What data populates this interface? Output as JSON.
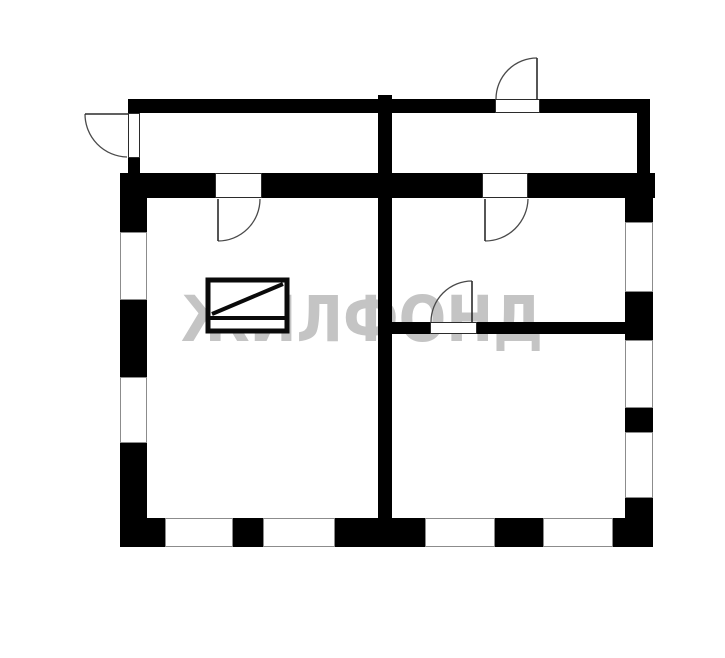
{
  "title": "apartment-floor-plan",
  "canvas": {
    "width": 725,
    "height": 658,
    "background": "#ffffff"
  },
  "watermark": {
    "text": "ЖИЛФОНД",
    "color": "#c4c4c4"
  },
  "style": {
    "wall_color": "#000000",
    "window_fill": "#ffffff",
    "window_stroke": "#8c8c8c",
    "opening_fill": "#ffffff",
    "opening_stroke": "#2b2b2b",
    "door_arc_color": "#4a4a4a",
    "symbol_color": "#0a0a0a"
  },
  "plan": {
    "walls": [
      {
        "name": "corridor-top-wall-left",
        "x": 128,
        "y": 99,
        "w": 367,
        "h": 14
      },
      {
        "name": "corridor-top-wall-right",
        "x": 540,
        "y": 99,
        "w": 110,
        "h": 14
      },
      {
        "name": "corridor-left-wall-stub",
        "x": 128,
        "y": 158,
        "w": 12,
        "h": 16
      },
      {
        "name": "corridor-right-wall",
        "x": 637,
        "y": 113,
        "w": 13,
        "h": 61
      },
      {
        "name": "center-wall",
        "x": 378,
        "y": 95,
        "w": 14,
        "h": 428
      },
      {
        "name": "top-wall-left",
        "x": 120,
        "y": 173,
        "w": 95,
        "h": 25
      },
      {
        "name": "top-wall-middle",
        "x": 262,
        "y": 173,
        "w": 220,
        "h": 25
      },
      {
        "name": "top-wall-right",
        "x": 528,
        "y": 173,
        "w": 127,
        "h": 25
      },
      {
        "name": "left-wall-upper",
        "x": 120,
        "y": 198,
        "w": 27,
        "h": 34
      },
      {
        "name": "left-wall-middle",
        "x": 120,
        "y": 300,
        "w": 27,
        "h": 77
      },
      {
        "name": "left-wall-lower",
        "x": 120,
        "y": 443,
        "w": 27,
        "h": 104
      },
      {
        "name": "bottom-wall-seg-1",
        "x": 120,
        "y": 518,
        "w": 45,
        "h": 29
      },
      {
        "name": "bottom-wall-seg-2",
        "x": 233,
        "y": 518,
        "w": 30,
        "h": 29
      },
      {
        "name": "bottom-wall-seg-3",
        "x": 335,
        "y": 518,
        "w": 90,
        "h": 29
      },
      {
        "name": "bottom-wall-seg-4",
        "x": 495,
        "y": 518,
        "w": 48,
        "h": 29
      },
      {
        "name": "bottom-wall-seg-5",
        "x": 613,
        "y": 518,
        "w": 40,
        "h": 29
      },
      {
        "name": "right-wall-upper",
        "x": 625,
        "y": 198,
        "w": 28,
        "h": 24
      },
      {
        "name": "right-wall-mid-1",
        "x": 625,
        "y": 292,
        "w": 28,
        "h": 48
      },
      {
        "name": "right-wall-mid-2",
        "x": 625,
        "y": 408,
        "w": 28,
        "h": 24
      },
      {
        "name": "right-wall-lower",
        "x": 625,
        "y": 498,
        "w": 28,
        "h": 49
      },
      {
        "name": "partition-wall-left",
        "x": 392,
        "y": 322,
        "w": 38,
        "h": 12
      },
      {
        "name": "partition-wall-right",
        "x": 477,
        "y": 322,
        "w": 148,
        "h": 12
      }
    ],
    "windows": [
      {
        "name": "window-left-upper",
        "x": 120,
        "y": 232,
        "w": 27,
        "h": 68
      },
      {
        "name": "window-left-lower",
        "x": 120,
        "y": 377,
        "w": 27,
        "h": 66
      },
      {
        "name": "window-bottom-1",
        "x": 165,
        "y": 518,
        "w": 68,
        "h": 29
      },
      {
        "name": "window-bottom-2",
        "x": 263,
        "y": 518,
        "w": 72,
        "h": 29
      },
      {
        "name": "window-bottom-3",
        "x": 425,
        "y": 518,
        "w": 70,
        "h": 29
      },
      {
        "name": "window-bottom-4",
        "x": 543,
        "y": 518,
        "w": 70,
        "h": 29
      },
      {
        "name": "window-right-upper",
        "x": 625,
        "y": 222,
        "w": 28,
        "h": 70
      },
      {
        "name": "window-right-middle",
        "x": 625,
        "y": 340,
        "w": 28,
        "h": 68
      },
      {
        "name": "window-right-lower",
        "x": 625,
        "y": 432,
        "w": 28,
        "h": 66
      }
    ],
    "door_openings": [
      {
        "name": "door-opening-entry-left",
        "x": 128,
        "y": 113,
        "w": 12,
        "h": 45
      },
      {
        "name": "door-opening-entry-top",
        "x": 495,
        "y": 99,
        "w": 45,
        "h": 14
      },
      {
        "name": "door-opening-left-room",
        "x": 215,
        "y": 173,
        "w": 47,
        "h": 25
      },
      {
        "name": "door-opening-upper-right-room",
        "x": 482,
        "y": 173,
        "w": 46,
        "h": 25
      },
      {
        "name": "door-opening-partition",
        "x": 430,
        "y": 322,
        "w": 47,
        "h": 12
      }
    ],
    "door_leaves": [
      {
        "name": "door-leaf-entry-left",
        "x1": 85,
        "y1": 114,
        "x2": 128,
        "y2": 114
      },
      {
        "name": "door-leaf-entry-top",
        "x1": 537,
        "y1": 58,
        "x2": 537,
        "y2": 99
      },
      {
        "name": "door-leaf-left-room",
        "x1": 218,
        "y1": 199,
        "x2": 218,
        "y2": 241
      },
      {
        "name": "door-leaf-upper-right-room",
        "x1": 485,
        "y1": 199,
        "x2": 485,
        "y2": 241
      },
      {
        "name": "door-leaf-partition",
        "x1": 472,
        "y1": 281,
        "x2": 472,
        "y2": 322
      }
    ],
    "door_arcs": [
      {
        "name": "door-arc-entry-left",
        "d": "M 85 114 A 43 43 0 0 0 127 157"
      },
      {
        "name": "door-arc-entry-top",
        "d": "M 537 58 A 41 41 0 0 0 496 99"
      },
      {
        "name": "door-arc-left-room",
        "d": "M 218 241 A 42 42 0 0 0 260 199"
      },
      {
        "name": "door-arc-upper-right-room",
        "d": "M 485 241 A 43 43 0 0 0 528 199"
      },
      {
        "name": "door-arc-partition",
        "d": "M 472 281 A 41 41 0 0 0 431 322"
      }
    ],
    "stove_symbol": {
      "rect": {
        "x": 208,
        "y": 280,
        "w": 79,
        "h": 51,
        "stroke_width": 5
      },
      "lines": [
        {
          "name": "stove-divider-line",
          "x1": 208,
          "y1": 318,
          "x2": 287,
          "y2": 318,
          "stroke_width": 4
        },
        {
          "name": "stove-diagonal-line",
          "x1": 212,
          "y1": 314,
          "x2": 283,
          "y2": 284,
          "stroke_width": 4
        }
      ]
    }
  }
}
